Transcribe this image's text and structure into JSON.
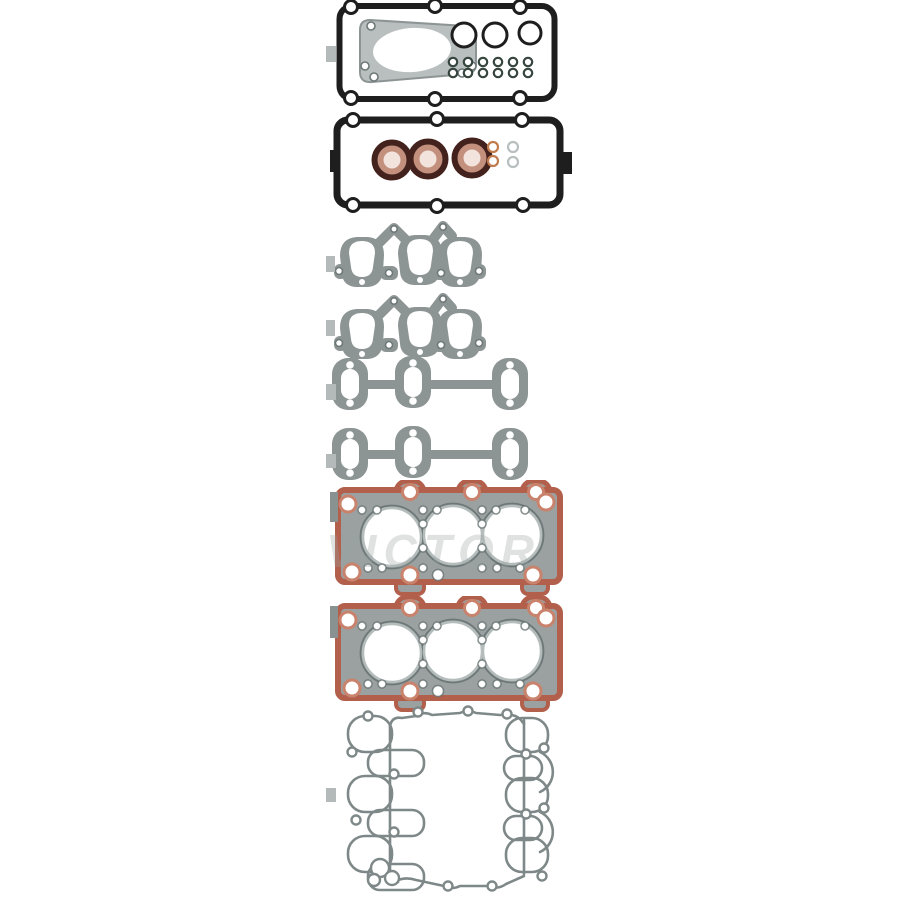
{
  "image": {
    "background": "#ffffff",
    "subject": "engine-cylinder-head-gasket-set-product-photo"
  },
  "watermark": {
    "text": "VICTOR"
  },
  "colors": {
    "bg": "#ffffff",
    "ink": "#1e1e1e",
    "gray": "#8d9494",
    "graydark": "#6e7878",
    "lightgray": "#b9bfbf",
    "tabgray": "#b4baba",
    "darkteal": "#36453e",
    "sealdark": "#43211c",
    "sealpink": "#c4907e",
    "sealcenter": "#f2e3dc",
    "orange": "#c07b4e",
    "terracotta": "#b2604c",
    "orangering": "#c9826b",
    "body": "#9ba1a1",
    "borering": "#b5bcbc",
    "line": "#7f8888",
    "watermark": "#9aa3a3"
  },
  "parts": [
    {
      "id": "valve-cover-gasket-upper"
    },
    {
      "id": "valve-cover-gasket-lower"
    },
    {
      "id": "exhaust-manifold-gasket-1"
    },
    {
      "id": "exhaust-manifold-gasket-2"
    },
    {
      "id": "manifold-flange-gasket-1"
    },
    {
      "id": "manifold-flange-gasket-2"
    },
    {
      "id": "cylinder-head-gasket-1"
    },
    {
      "id": "cylinder-head-gasket-2"
    },
    {
      "id": "intake-manifold-gasket"
    }
  ]
}
